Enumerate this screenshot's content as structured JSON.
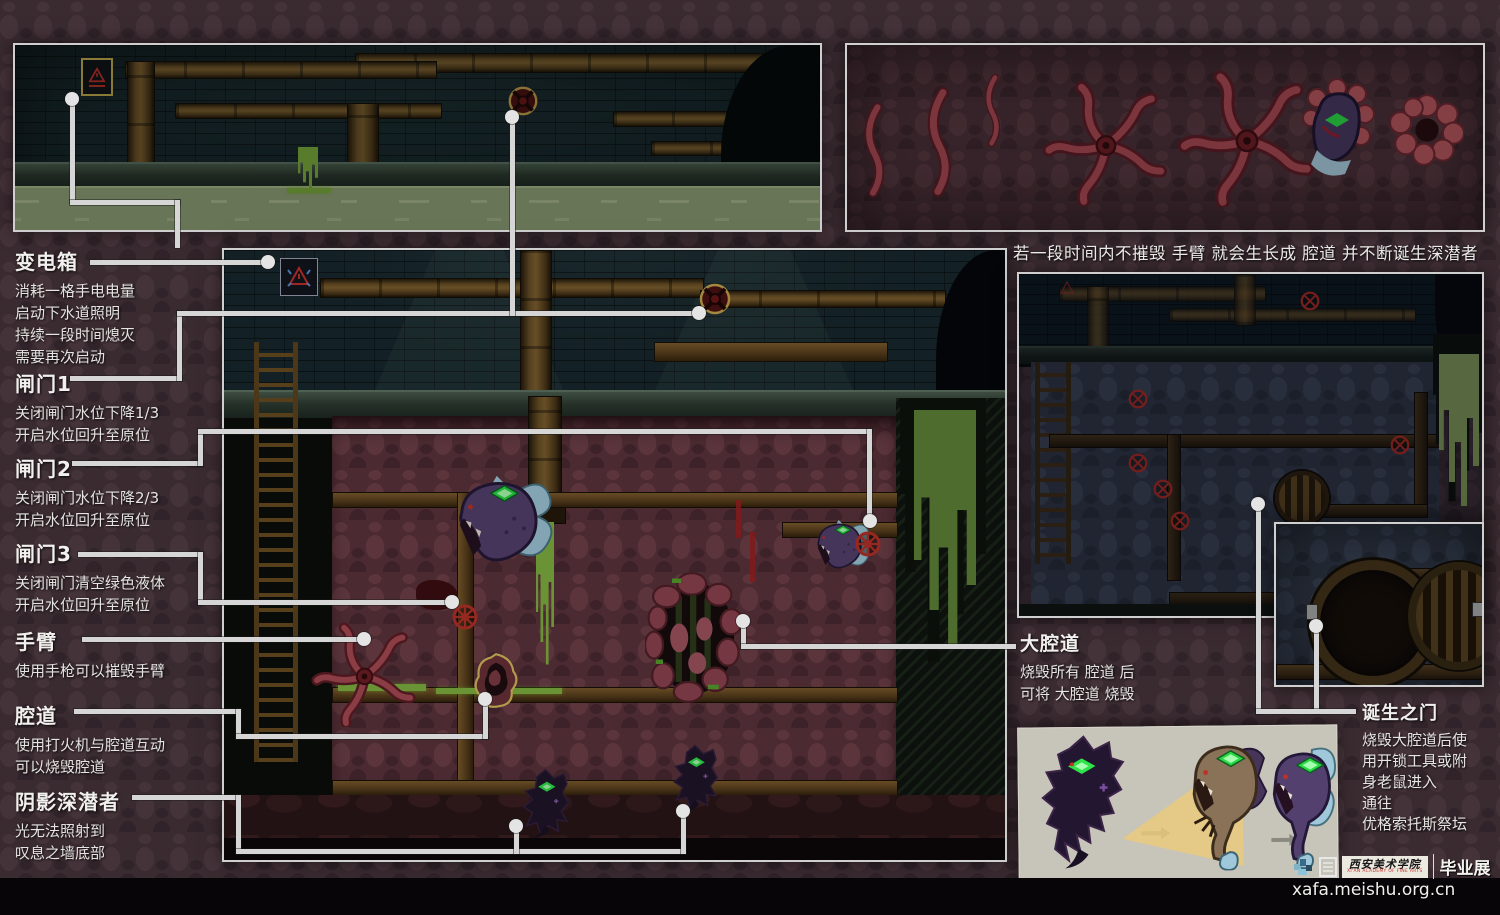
{
  "annotations": {
    "transformer": {
      "title": "变电箱",
      "lines": [
        "消耗一格手电电量",
        "启动下水道照明",
        "持续一段时间熄灭",
        "需要再次启动"
      ]
    },
    "gate1": {
      "title": "闸门1",
      "lines": [
        "关闭闸门水位下降1/3",
        "开启水位回升至原位"
      ]
    },
    "gate2": {
      "title": "闸门2",
      "lines": [
        "关闭闸门水位下降2/3",
        "开启水位回升至原位"
      ]
    },
    "gate3": {
      "title": "闸门3",
      "lines": [
        "关闭闸门清空绿色液体",
        "开启水位回升至原位"
      ]
    },
    "arm": {
      "title": "手臂",
      "lines": [
        "使用手枪可以摧毁手臂"
      ]
    },
    "cavity": {
      "title": "腔道",
      "lines": [
        "使用打火机与腔道互动",
        "可以烧毁腔道"
      ]
    },
    "shadow_diver": {
      "title": "阴影深潜者",
      "lines": [
        "光无法照射到",
        "叹息之墙底部"
      ]
    },
    "big_cavity": {
      "title": "大腔道",
      "lines": [
        "烧毁所有 腔道 后",
        "可将 大腔道 烧毁"
      ]
    },
    "birth_gate": {
      "title": "诞生之门",
      "lines": [
        "烧毁大腔道后使",
        "用开锁工具或附",
        "身老鼠进入",
        "通往",
        "优格索托斯祭坛"
      ]
    },
    "growth_note": "若一段时间内不摧毁 手臂 就会生长成 腔道 并不断诞生深潜者"
  },
  "watermark": {
    "academy": "西安美术学院",
    "academy_en": "XI'AN ACADEMY OF FINE ARTS",
    "exhibition": "毕业展",
    "url": "xafa.meishu.org.cn"
  },
  "icons": {
    "warning-sign-icon": "red triangle hazard sign",
    "valve-icon": "round valve wheel with cross spokes",
    "destroyed-valve-icon": "red circled X marker",
    "arrow-icon": "→",
    "hatch-icon": "round slatted manhole door"
  },
  "colors": {
    "panel_border": "#cfcfcf",
    "callout_line": "#d6d6d6",
    "flesh_red": "#5c333c",
    "flesh_blue": "#353c4a",
    "slime_green": "#7fb33f",
    "water_green": "#97a87e",
    "valve_red": "#b53026",
    "valve_gold_ring": "#c9a44c",
    "eye_green": "#2ee24a",
    "creature_purple": "#53406e",
    "fin_blue": "#9fc8da",
    "creature_panel_bg": "#c7c4b9"
  }
}
